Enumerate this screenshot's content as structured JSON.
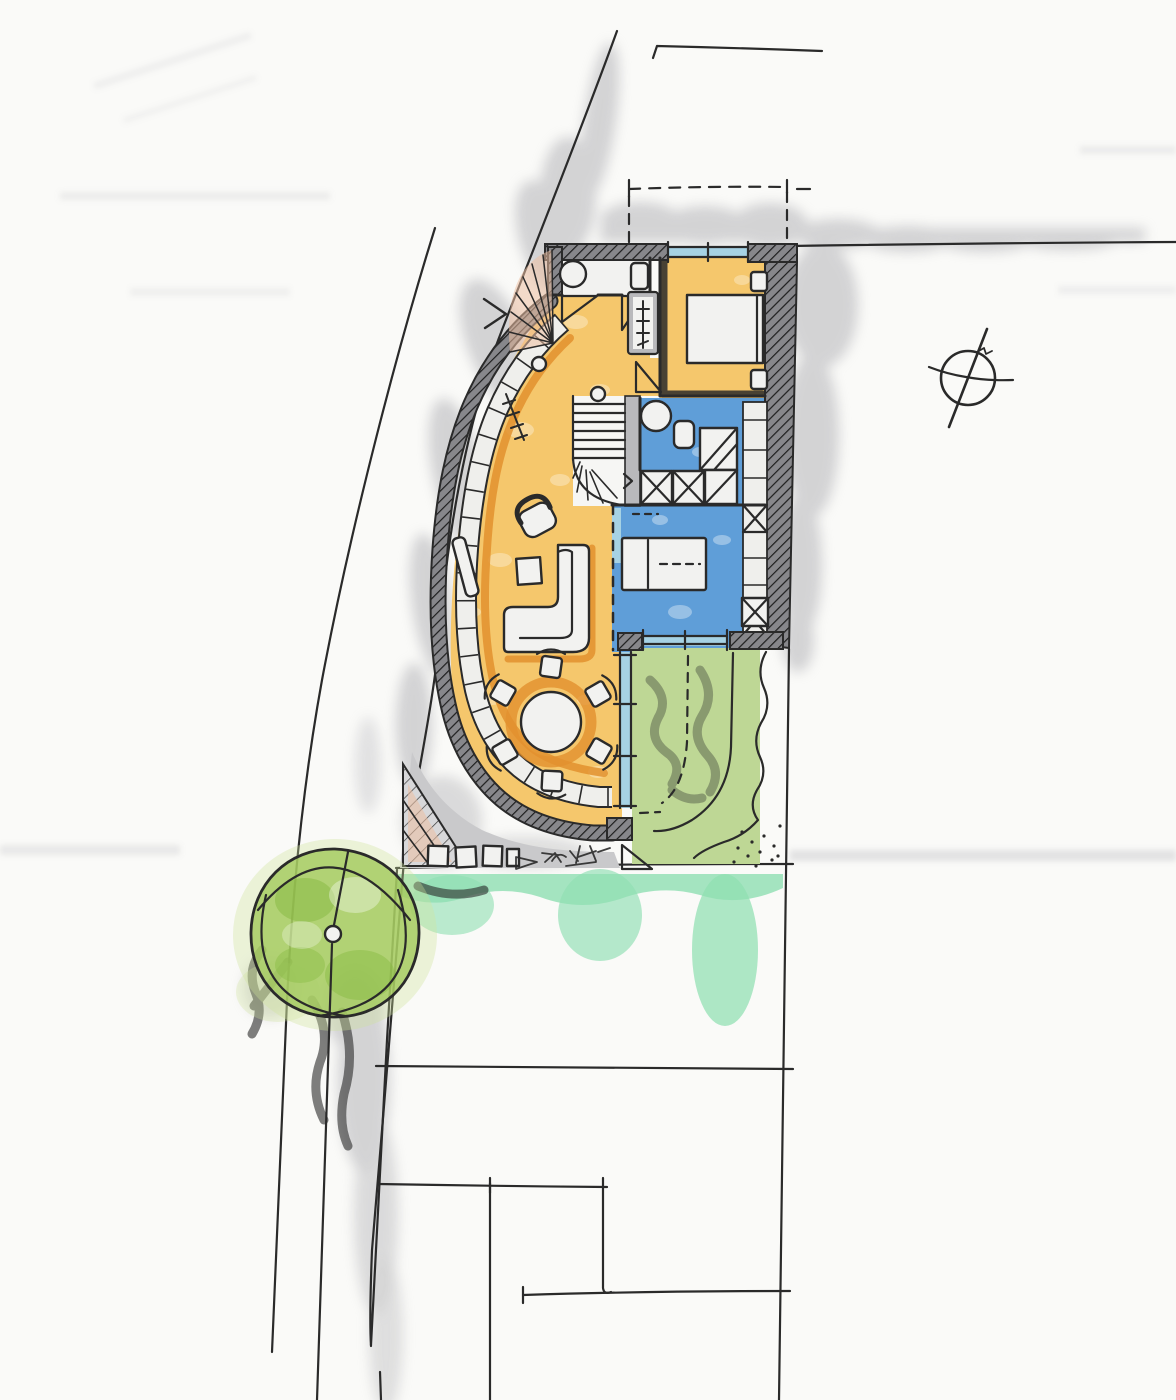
{
  "canvas": {
    "width": 1176,
    "height": 1400
  },
  "palette": {
    "paper": "#fafaf8",
    "ink": "#2a2a2a",
    "wall_mid": "#87878b",
    "wall_line": "#1e1e1e",
    "paving": "#c9c9cb",
    "shadow": "#b3b3b7",
    "floor_orange": "#f5c76c",
    "accent_orange": "#e2902e",
    "window_blue": "#a6d2e4",
    "room_blue": "#5f9ed8",
    "lawn_green": "#bed795",
    "lawn_scribble": "#95a67a",
    "tree_green": "#a4cb5e",
    "tree_dark": "#85b83f",
    "tree_light": "#cfe39b",
    "mint": "#8fdfb2",
    "peach": "#ecc0a2",
    "furn_white": "#f2f2f0",
    "closet": "#efefec"
  },
  "plan": {
    "medium": "hand-drawn felt-tip marker sketch on paper",
    "compass": {
      "symbol": "north-arrow-circle",
      "position": "top-right"
    },
    "site": {
      "road": "curved street sweeping along the west side",
      "tree": {
        "symbol": "circle-with-arcs-and-trunk-dot",
        "fill": "tree_green"
      },
      "boundaries": [
        "dashed-setback-rectangle-north",
        "property-line-north-east",
        "property-line-east-vertical",
        "neighbor-plot-lines-south"
      ],
      "ground": [
        "gray-forecourt-paving-south-west",
        "mint-lawn-strip-south",
        "stipple-gravel-corner"
      ]
    },
    "building": {
      "rooms": [
        {
          "name": "wc-bathroom-north",
          "fill": "furn_white",
          "fixtures": [
            "round-basin",
            "wc",
            "two-door-swings"
          ]
        },
        {
          "name": "bedroom-northeast",
          "fill": "floor_orange",
          "furniture": [
            "double-bed",
            "nightstand",
            "nightstand"
          ],
          "window": "north"
        },
        {
          "name": "wardrobe-closet",
          "fill": "closet",
          "symbol": "hanger-rail-with-crosses"
        },
        {
          "name": "stair-winder",
          "fill": "furn_white",
          "parts": [
            "treads",
            "curved-winders",
            "newel-circle"
          ]
        },
        {
          "name": "bathroom-center",
          "fill": "room_blue",
          "fixtures": [
            "round-basin",
            "wc",
            "shower-diagonal",
            "shaft-x-boxes"
          ]
        },
        {
          "name": "bedroom-center",
          "fill": "room_blue",
          "furniture": [
            "bed-with-dashed-half"
          ],
          "partition": "dashed-line-west"
        },
        {
          "name": "living-room",
          "fill": "floor_orange",
          "furniture": [
            "armchair",
            "l-shaped-sofa",
            "side-table",
            "sideboard"
          ]
        },
        {
          "name": "dining-area",
          "fill": "floor_orange",
          "furniture": [
            "round-table",
            "six-chairs"
          ]
        },
        {
          "name": "terrace-garden",
          "fill": "lawn_green",
          "features": [
            "hedge-wavy-east",
            "dashed-step-path",
            "solid-path-curve",
            "gravel-dots"
          ]
        }
      ],
      "envelope": [
        "hatched-north-wall",
        "hatched-east-wall-with-closet-band",
        "curved-west-wall-double-band",
        "glazed-strips-blue"
      ]
    }
  }
}
